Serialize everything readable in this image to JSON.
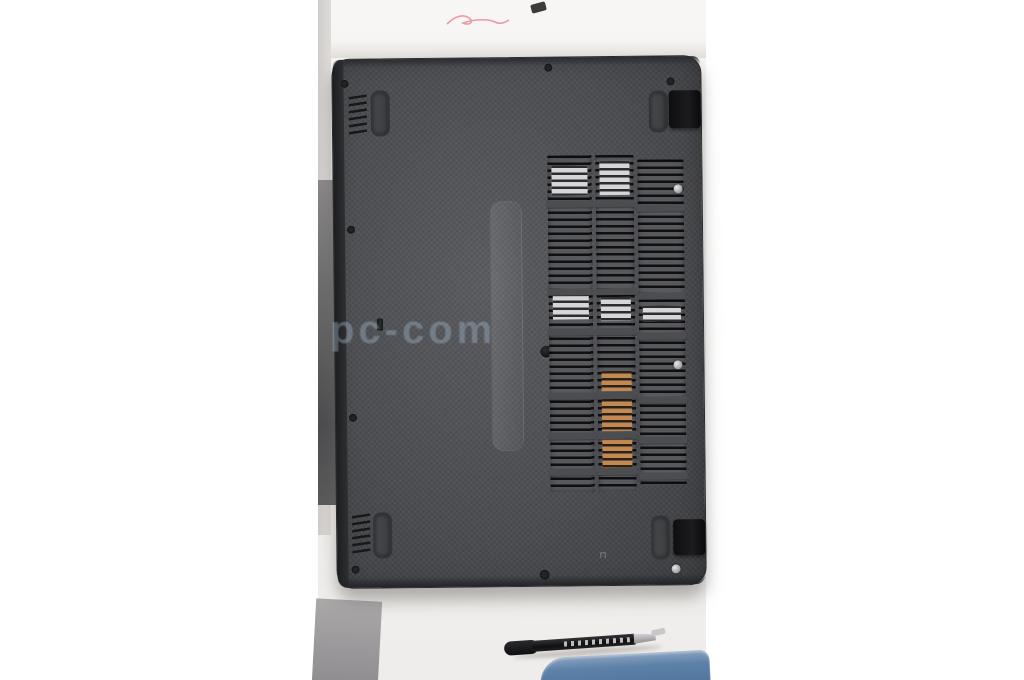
{
  "scene": {
    "description": "Product photo of a dark gray laptop bottom base cover lying face-up on white paper, hinges on the right, cooling vent slots on the right half, a black marker pen and the corner of a blue object at the bottom",
    "watermark_text": "pc-com",
    "tiny_marking_glyph": "⊓"
  },
  "colors": {
    "canvas_background": "#ffffff",
    "paper": "#f3f1ef",
    "table_surface": "#9d9b9c",
    "case_base": "#4d4e52",
    "case_edge": "#242528",
    "hinge_black": "#121214",
    "vent_dark": "#0c0c0e",
    "vent_silver": "#d6d6d8",
    "heatsink_copper": "#c28a52",
    "watermark_blue": "#9eb2c6",
    "pen_black": "#141416",
    "pen_metal": "#c8c8ca",
    "blue_object": "#5d81a8",
    "pink_mark": "#e06a7e"
  },
  "vents": {
    "columns": [
      {
        "x": 214,
        "y": 98,
        "w": 44,
        "h": 336
      },
      {
        "x": 262,
        "y": 98,
        "w": 38,
        "h": 336
      },
      {
        "x": 304,
        "y": 103,
        "w": 46,
        "h": 326
      }
    ],
    "separator_offsets": [
      45,
      133,
      173,
      237,
      277,
      313
    ],
    "separator_height": 7,
    "silver_patches": [
      {
        "col": 0,
        "y": 10,
        "h": 30
      },
      {
        "col": 1,
        "y": 6,
        "h": 34
      },
      {
        "col": 0,
        "y": 138,
        "h": 26
      },
      {
        "col": 1,
        "y": 142,
        "h": 24
      },
      {
        "col": 2,
        "y": 146,
        "h": 16
      }
    ],
    "copper_patches": [
      {
        "col": 1,
        "y": 216,
        "h": 20
      },
      {
        "col": 1,
        "y": 244,
        "h": 32
      },
      {
        "col": 1,
        "y": 282,
        "h": 32
      }
    ]
  }
}
